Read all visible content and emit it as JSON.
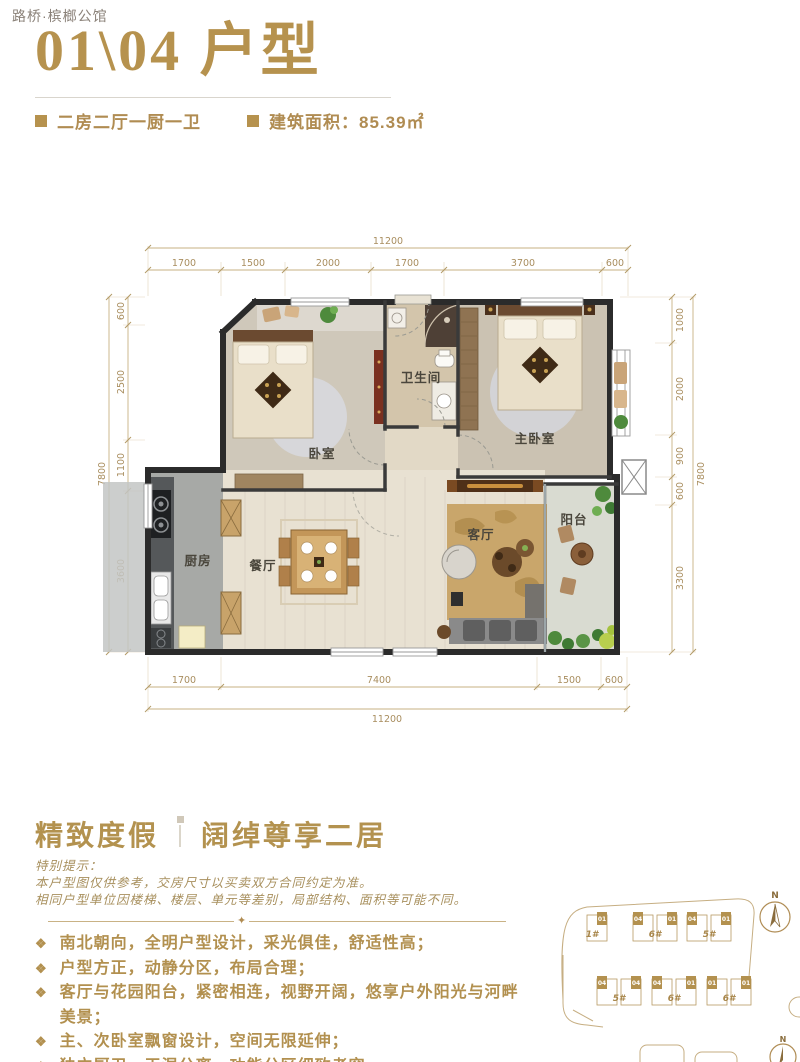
{
  "header": {
    "brand": "路桥·槟榔公馆"
  },
  "title": {
    "main": "01\\04 户型"
  },
  "specs": {
    "layout": "二房二厅一厨一卫",
    "area": "建筑面积：85.39㎡"
  },
  "plan": {
    "rooms": {
      "bedroom": "卧室",
      "bathroom": "卫生间",
      "master": "主卧室",
      "kitchen": "厨房",
      "dining": "餐厅",
      "living": "客厅",
      "balcony": "阳台"
    },
    "dims": {
      "top_total": "11200",
      "top": [
        "1700",
        "1500",
        "2000",
        "1700",
        "3700",
        "600"
      ],
      "left_total": "7800",
      "left": [
        "600",
        "2500",
        "1100",
        "3600"
      ],
      "right_total": "7800",
      "right": [
        "1000",
        "2000",
        "900",
        "600",
        "3300"
      ],
      "bottom": [
        "1700",
        "7400",
        "1500",
        "600"
      ],
      "bottom_total": "11200"
    }
  },
  "tagline": {
    "left": "精致度假",
    "right": "阔绰尊享二居"
  },
  "notice": {
    "title": "特别提示：",
    "line1": "本户型图仅供参考，交房尺寸以买卖双方合同约定为准。",
    "line2": "相同户型单位因楼梯、楼层、单元等差别，局部结构、面积等可能不同。"
  },
  "ui": {
    "bullet": "❖",
    "divider_ornament": "✦"
  },
  "features": [
    "南北朝向，全明户型设计，采光俱佳，舒适性高；",
    "户型方正，动静分区，布局合理；",
    "客厅与花园阳台，紧密相连，视野开阔，悠享户外阳光与河畔美景；",
    "主、次卧室飘窗设计，空间无限延伸；",
    "独立厨卫，干湿分离，功能分区细致考究。"
  ],
  "siteplan": {
    "north": "N",
    "rows": [
      [
        {
          "name": "1#",
          "units": [
            "01"
          ]
        },
        {
          "name": "6#",
          "units": [
            "04",
            "01"
          ]
        },
        {
          "name": "5#",
          "units": [
            "04",
            "01"
          ]
        }
      ],
      [
        {
          "name": "5#",
          "units": [
            "04",
            "04"
          ]
        },
        {
          "name": "6#",
          "units": [
            "04",
            "01"
          ]
        },
        {
          "name": "6#",
          "units": [
            "01",
            "01"
          ]
        }
      ]
    ]
  },
  "colors": {
    "gold": "#b6924e",
    "dim_line": "#c7b183",
    "wall": "#2b2b2b"
  }
}
